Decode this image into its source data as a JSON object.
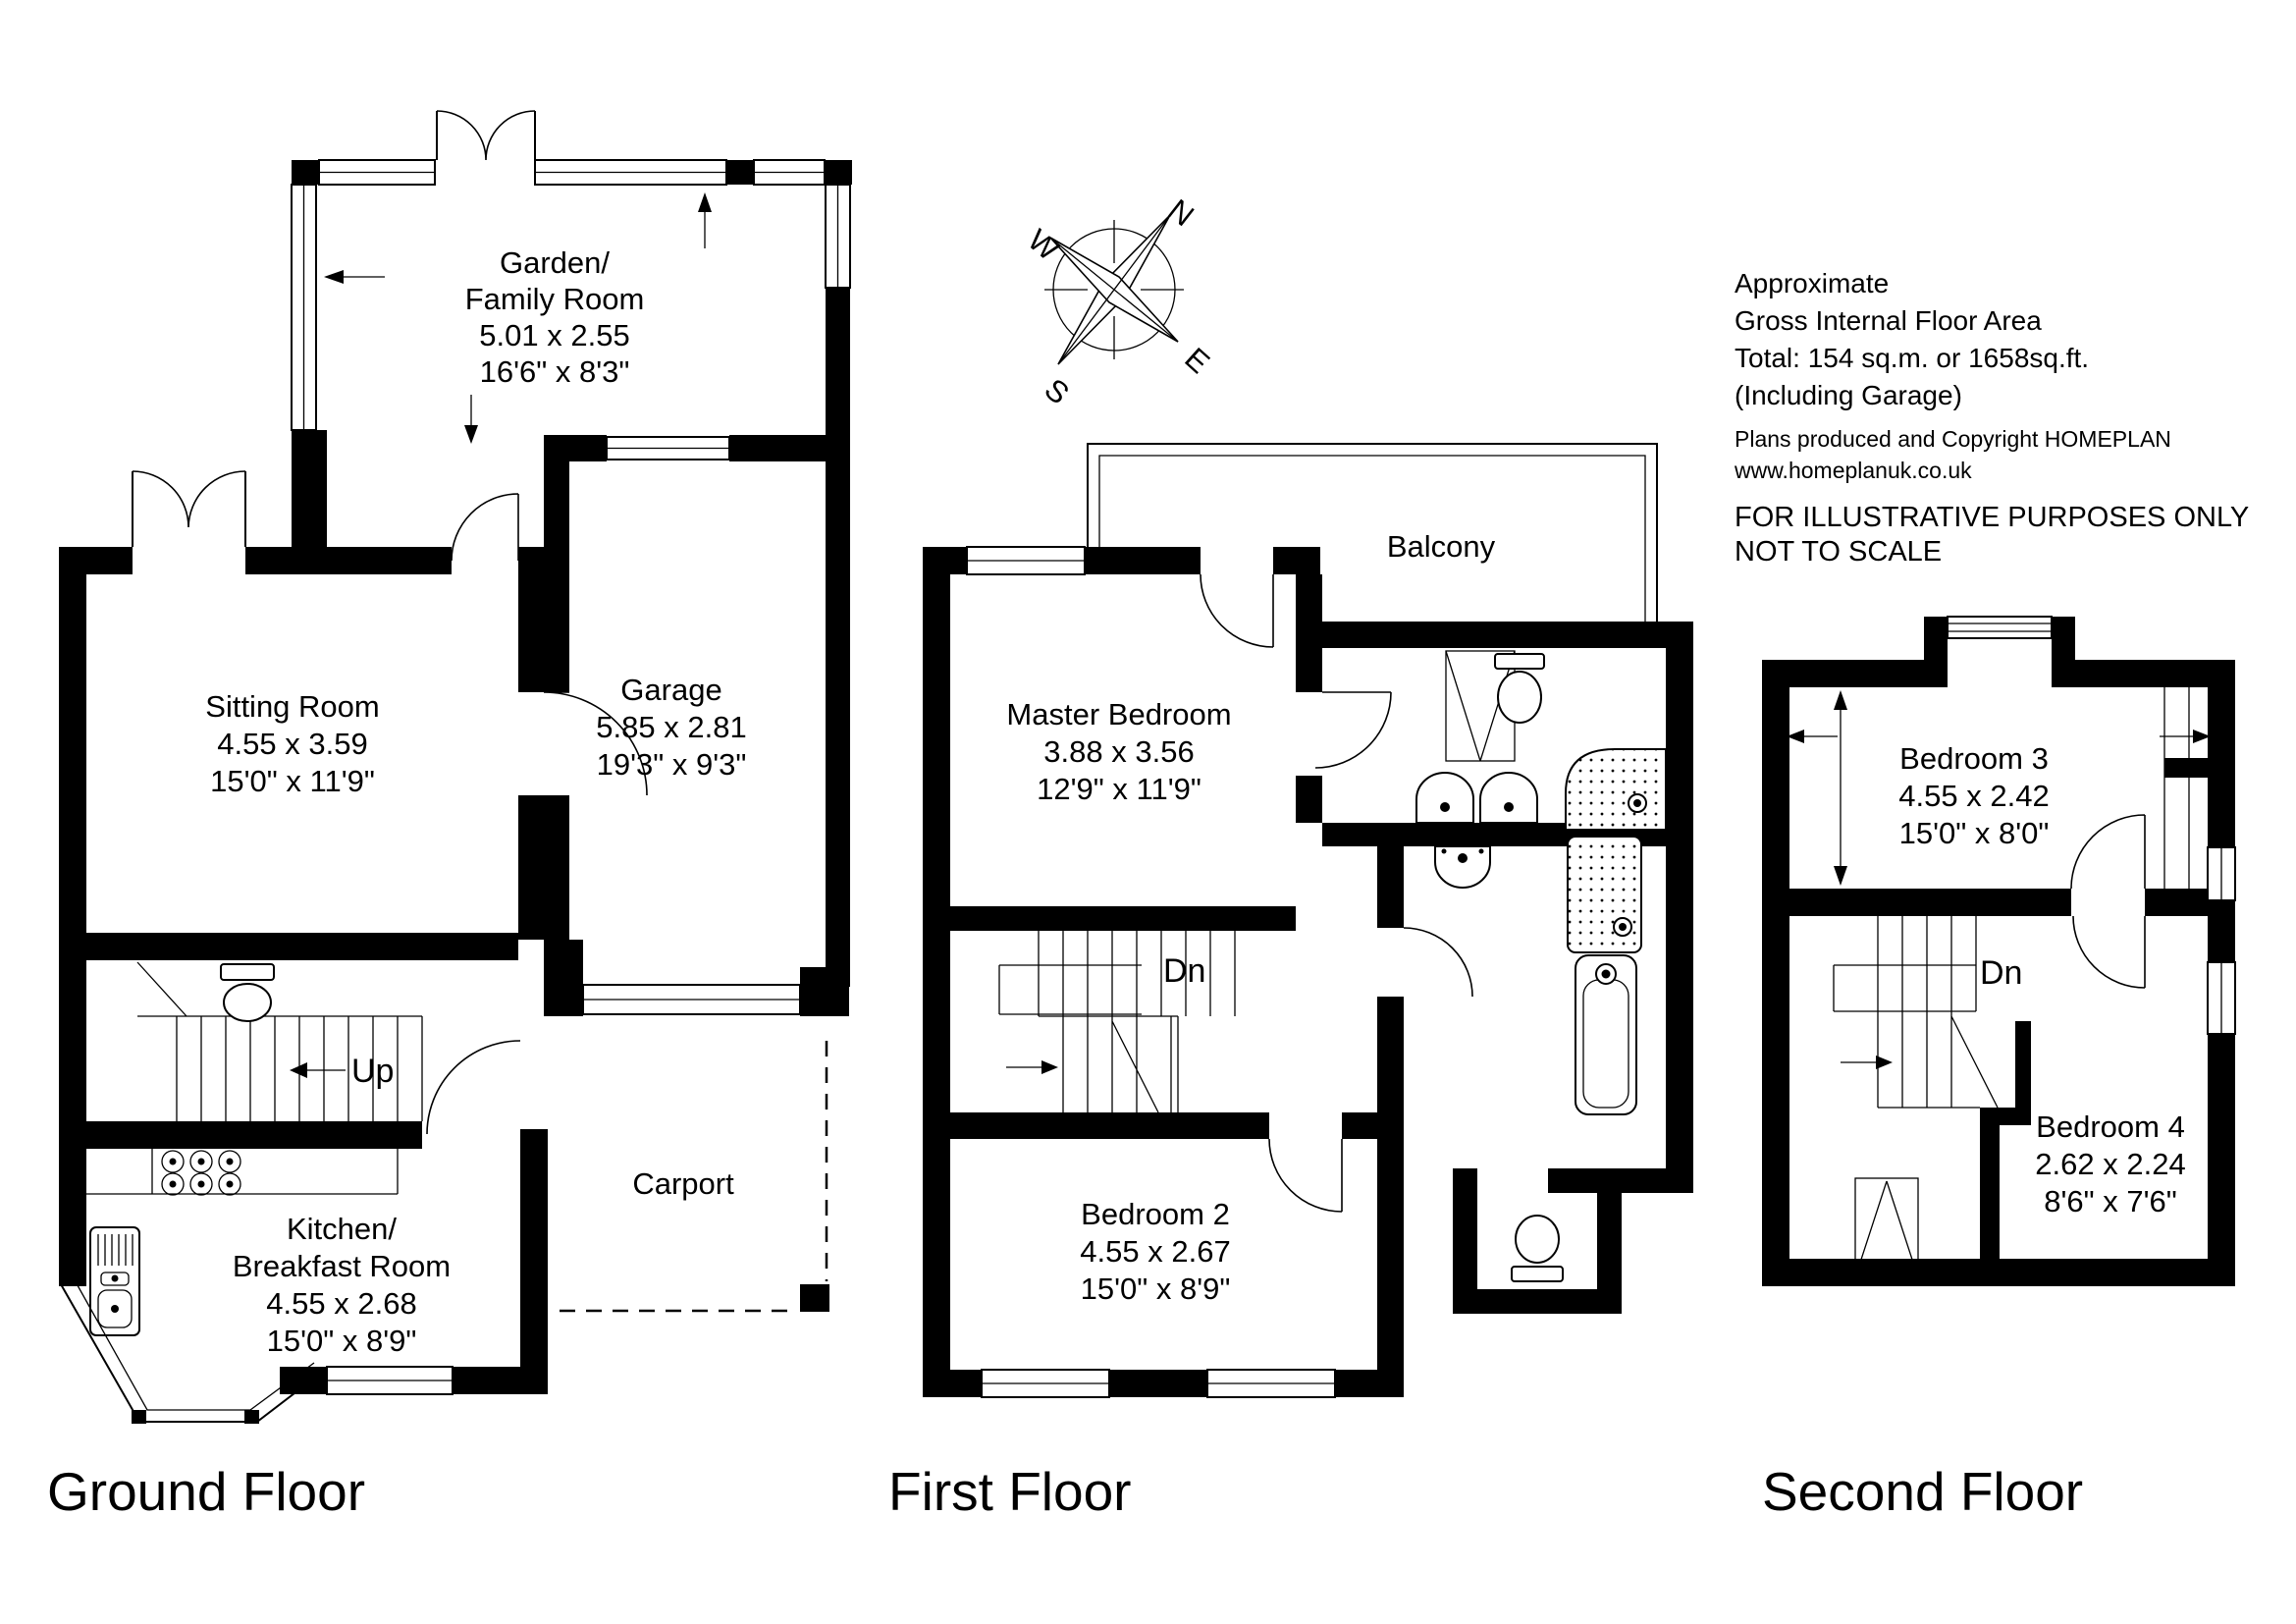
{
  "info": {
    "line1": "Approximate",
    "line2": "Gross Internal Floor Area",
    "line3": "Total: 154 sq.m. or 1658sq.ft.",
    "line4": "(Including Garage)",
    "copyright1": "Plans produced and Copyright HOMEPLAN",
    "copyright2": "www.homeplanuk.co.uk",
    "disclaimer1": "FOR ILLUSTRATIVE PURPOSES ONLY",
    "disclaimer2": "NOT TO SCALE"
  },
  "compass": {
    "n": "N",
    "e": "E",
    "s": "S",
    "w": "W"
  },
  "ground": {
    "title": "Ground Floor",
    "stairs_label": "Up",
    "garden": {
      "name1": "Garden/",
      "name2": "Family Room",
      "dim_m": "5.01 x 2.55",
      "dim_ft": "16'6\" x 8'3\""
    },
    "sitting": {
      "name": "Sitting Room",
      "dim_m": "4.55 x 3.59",
      "dim_ft": "15'0\" x 11'9\""
    },
    "garage": {
      "name": "Garage",
      "dim_m": "5.85 x 2.81",
      "dim_ft": "19'3\" x 9'3\""
    },
    "kitchen": {
      "name1": "Kitchen/",
      "name2": "Breakfast Room",
      "dim_m": "4.55 x 2.68",
      "dim_ft": "15'0\" x 8'9\""
    },
    "carport": {
      "name": "Carport"
    }
  },
  "first": {
    "title": "First Floor",
    "stairs_label": "Dn",
    "master": {
      "name": "Master Bedroom",
      "dim_m": "3.88 x 3.56",
      "dim_ft": "12'9\" x 11'9\""
    },
    "balcony": {
      "name": "Balcony"
    },
    "bedroom2": {
      "name": "Bedroom 2",
      "dim_m": "4.55 x 2.67",
      "dim_ft": "15'0\" x 8'9\""
    }
  },
  "second": {
    "title": "Second Floor",
    "stairs_label": "Dn",
    "bedroom3": {
      "name": "Bedroom 3",
      "dim_m": "4.55 x 2.42",
      "dim_ft": "15'0\" x 8'0\""
    },
    "bedroom4": {
      "name": "Bedroom 4",
      "dim_m": "2.62 x 2.24",
      "dim_ft": "8'6\" x 7'6\""
    }
  }
}
